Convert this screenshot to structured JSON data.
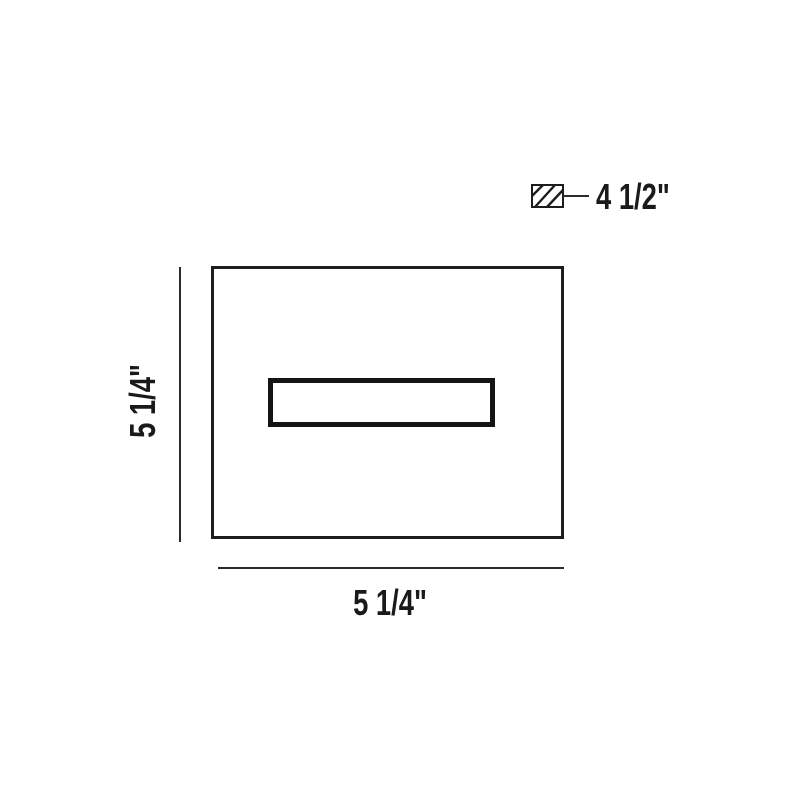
{
  "diagram": {
    "type": "product-dimension-drawing",
    "dimensions": {
      "height": "5 1/4\"",
      "width": "5 1/4\"",
      "depth": "4 1/2\""
    },
    "icons": {
      "depth_symbol": "hatched-rectangle-section-icon"
    },
    "colors": {
      "line": "#1d1d1d",
      "text": "#1a1a1a",
      "background": "#ffffff"
    }
  }
}
